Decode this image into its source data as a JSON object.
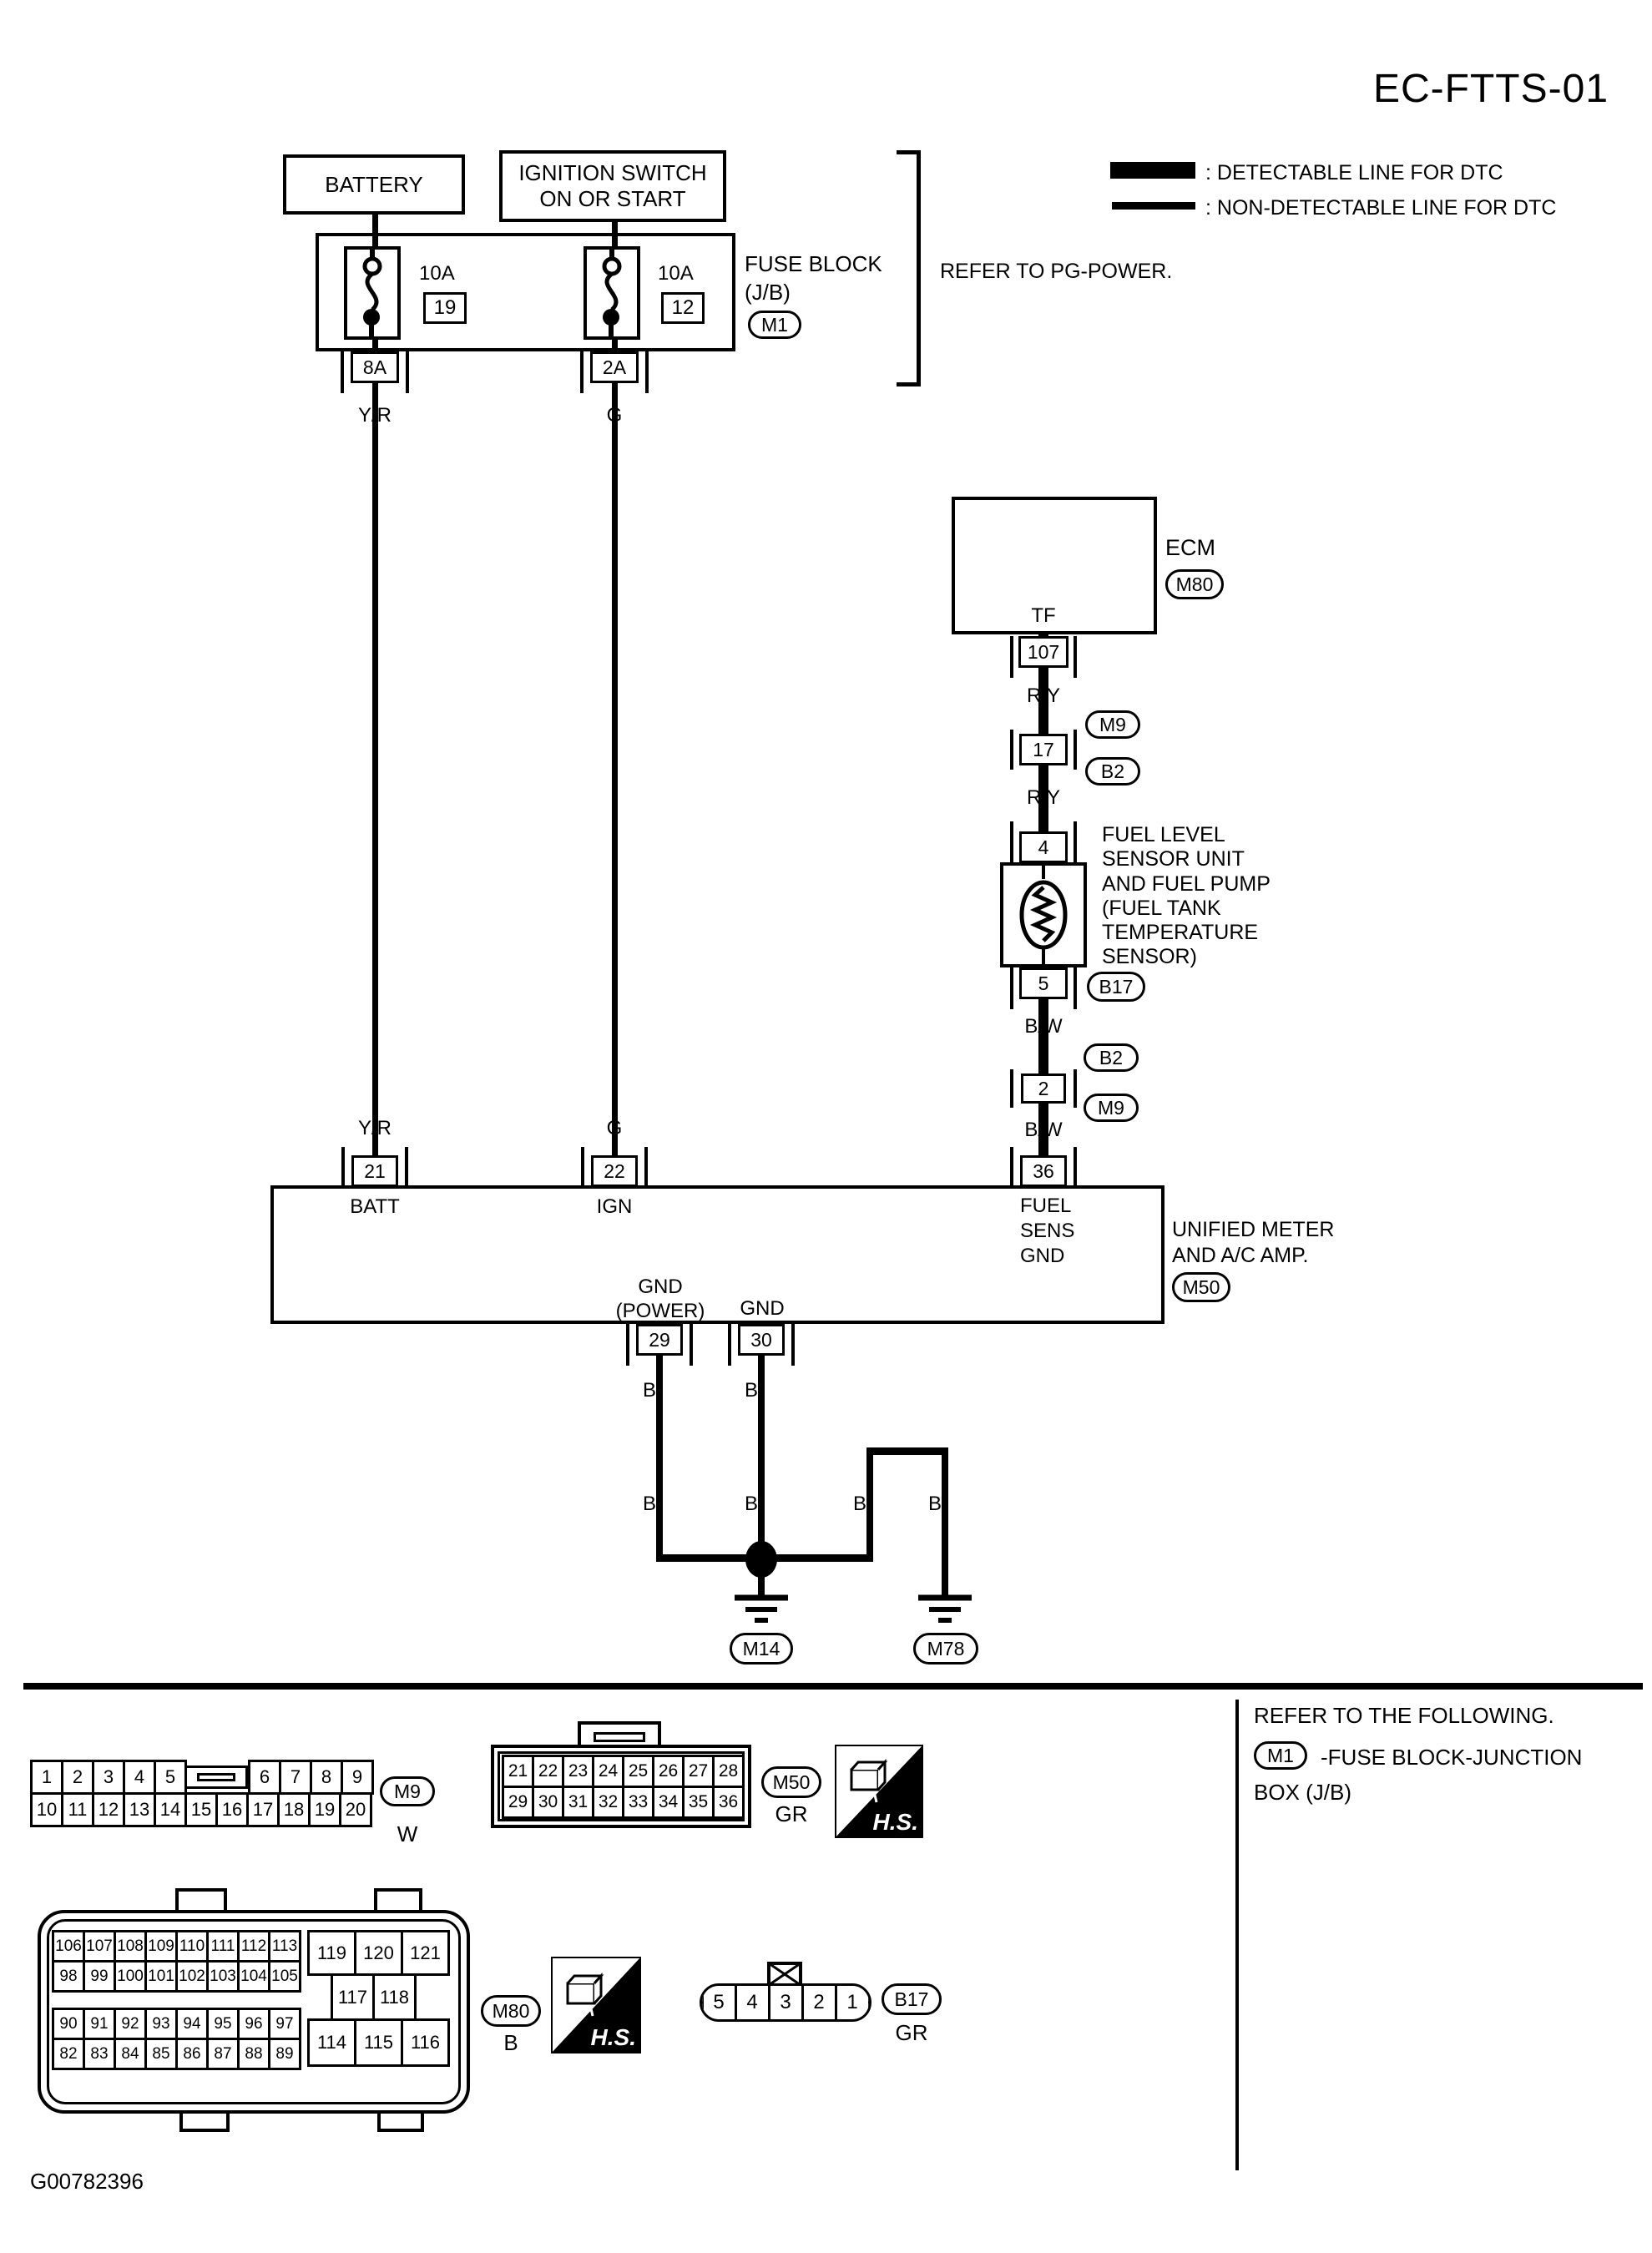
{
  "page": {
    "title": "EC-FTTS-01",
    "doc_id": "G00782396"
  },
  "legend": {
    "detectable": ": DETECTABLE LINE FOR DTC",
    "non_detectable": ": NON-DETECTABLE LINE FOR DTC"
  },
  "notes": {
    "refer_pg_power": "REFER TO PG-POWER."
  },
  "power": {
    "battery_label": "BATTERY",
    "ignition_label": "IGNITION SWITCH\nON OR START",
    "fuse_block_label": "FUSE BLOCK\n(J/B)",
    "fuse_block_badge": "M1",
    "fuse1": {
      "amp": "10A",
      "number": "19",
      "terminal": "8A",
      "wire_color": "Y/R"
    },
    "fuse2": {
      "amp": "10A",
      "number": "12",
      "terminal": "2A",
      "wire_color": "G"
    }
  },
  "ecm": {
    "label": "ECM",
    "badge": "M80",
    "pin_name": "TF",
    "terminal": "107"
  },
  "sensor_chain": {
    "wire1": "R/Y",
    "conn17": {
      "terminal": "17",
      "badge_top": "M9",
      "badge_bottom": "B2"
    },
    "wire2": "R/Y",
    "fuel_sensor": {
      "pin_top": "4",
      "pin_bottom": "5",
      "badge": "B17",
      "label": "FUEL LEVEL\nSENSOR UNIT\nAND FUEL PUMP\n(FUEL TANK\nTEMPERATURE\nSENSOR)"
    },
    "wire3": "B/W",
    "conn2": {
      "terminal": "2",
      "badge_top": "B2",
      "badge_bottom": "M9"
    },
    "wire4": "B/W"
  },
  "meter": {
    "label": "UNIFIED METER\nAND A/C AMP.",
    "badge": "M50",
    "batt": {
      "terminal": "21",
      "name": "BATT",
      "wire": "Y/R"
    },
    "ign": {
      "terminal": "22",
      "name": "IGN",
      "wire": "G"
    },
    "fuel": {
      "terminal": "36",
      "name": "FUEL\nSENS\nGND",
      "wire": "B/W"
    },
    "gnd_power": {
      "terminal": "29",
      "name": "GND\n(POWER)"
    },
    "gnd": {
      "terminal": "30",
      "name": "GND"
    }
  },
  "grounds": {
    "wire": "B",
    "g1": "M14",
    "g2": "M78"
  },
  "footer": {
    "refer": "REFER TO THE FOLLOWING.",
    "m1_badge": "M1",
    "m1_text": "-FUSE BLOCK-JUNCTION",
    "m1_text2": "BOX (J/B)"
  },
  "hs_label": "H.S.",
  "connector_views": {
    "m9": {
      "badge": "M9",
      "color": "W",
      "row1a": [
        "1",
        "2",
        "3",
        "4",
        "5"
      ],
      "row1b": [
        "6",
        "7",
        "8",
        "9"
      ],
      "row2": [
        "10",
        "11",
        "12",
        "13",
        "14",
        "15",
        "16",
        "17",
        "18",
        "19",
        "20"
      ]
    },
    "m50": {
      "badge": "M50",
      "color": "GR",
      "row1": [
        "21",
        "22",
        "23",
        "24",
        "25",
        "26",
        "27",
        "28"
      ],
      "row2": [
        "29",
        "30",
        "31",
        "32",
        "33",
        "34",
        "35",
        "36"
      ]
    },
    "m80": {
      "badge": "M80",
      "color": "B",
      "blockA_row1": [
        "106",
        "107",
        "108",
        "109",
        "110",
        "111",
        "112",
        "113"
      ],
      "blockA_row2": [
        "98",
        "99",
        "100",
        "101",
        "102",
        "103",
        "104",
        "105"
      ],
      "blockB_row1": [
        "90",
        "91",
        "92",
        "93",
        "94",
        "95",
        "96",
        "97"
      ],
      "blockB_row2": [
        "82",
        "83",
        "84",
        "85",
        "86",
        "87",
        "88",
        "89"
      ],
      "right_row1": [
        "119",
        "120",
        "121"
      ],
      "right_row2": [
        "117",
        "118"
      ],
      "right_row3": [
        "114",
        "115",
        "116"
      ]
    },
    "b17": {
      "badge": "B17",
      "color": "GR",
      "pins": [
        "5",
        "4",
        "3",
        "2",
        "1"
      ]
    }
  }
}
